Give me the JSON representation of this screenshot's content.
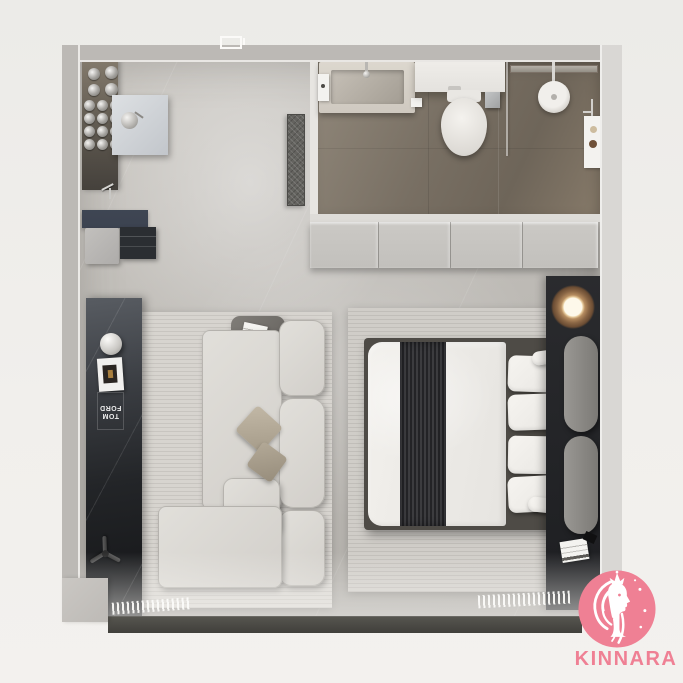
{
  "brand": {
    "name": "KINNARA",
    "logo_icon": "kinnara-figure-icon",
    "accent_color": "#ef8094"
  },
  "living": {
    "book": {
      "line1": "TOM",
      "line2": "FORD"
    }
  },
  "palette": {
    "background": "#efedea",
    "wall": "#bcb9b5",
    "wall_light": "#d9d7d4",
    "floor_concrete": "#bfbcb7",
    "bathroom_floor": "#786f63",
    "wardrobe": "#c8c6c2",
    "media_console": "#1d1e20",
    "sofa": "#dcdad5",
    "rug": "#d2cfca",
    "bed_linen": "#efede9",
    "blanket": "#333336",
    "headboard_gray": "#8b8987",
    "window_ledge": "#4a4946",
    "copper_lamp": "#97765a",
    "kitchen_cabinet_navy": "#3c4350",
    "brand_pink": "#ef8094"
  }
}
